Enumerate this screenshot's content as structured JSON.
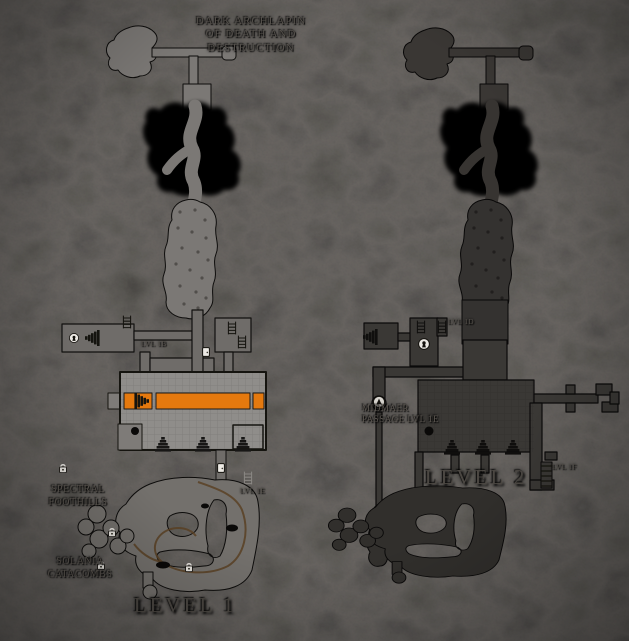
{
  "image_type": "two-level dungeon map on dark rock background",
  "title": {
    "line1": "DARK ARCHLAPIN",
    "line2": "OF DEATH AND",
    "line3": "DESTRUCTION"
  },
  "level1": {
    "name": "LEVEL 1",
    "labels": {
      "spectral_foothills_line1": "SPECTRAL",
      "spectral_foothills_line2": "FOOTHILLS",
      "solania_catacombs_line1": "SOLANIA",
      "solania_catacombs_line2": "CATACOMBS",
      "stair_b": "LVL 1B",
      "stair_e": "LVL 1E"
    }
  },
  "level2": {
    "name": "LEVEL 2",
    "labels": {
      "midmaer_line1": "MIDMAER",
      "midmaer_line2": "PASSAGE LVL 1E",
      "stair_d": "LVL 1D",
      "stair_f": "LVL 1F"
    }
  },
  "colors": {
    "background_rock": "#171514",
    "black_cavern": "#060606",
    "level1_room": "#8f8d8a",
    "level1_corridor": "#6f6c69",
    "level1_cave": "#7b7875",
    "level1_bottom_cave": "#73706c",
    "highlight_orange": "#e5790e",
    "trail_brown": "#5a4124",
    "level2_room": "#3a3835",
    "level2_cave": "#343230",
    "level2_bottom_cave": "#312f2c",
    "icon_white": "#ece9e4",
    "label_text": "#56524d"
  },
  "icons": {
    "door": "door-icon",
    "lock": "lock-icon",
    "keyhole_door": "keyhole-door-icon",
    "stairs": "stairs-icon",
    "ladder": "ladder-icon",
    "pick": "pick-icon",
    "pit": "pit-icon"
  }
}
